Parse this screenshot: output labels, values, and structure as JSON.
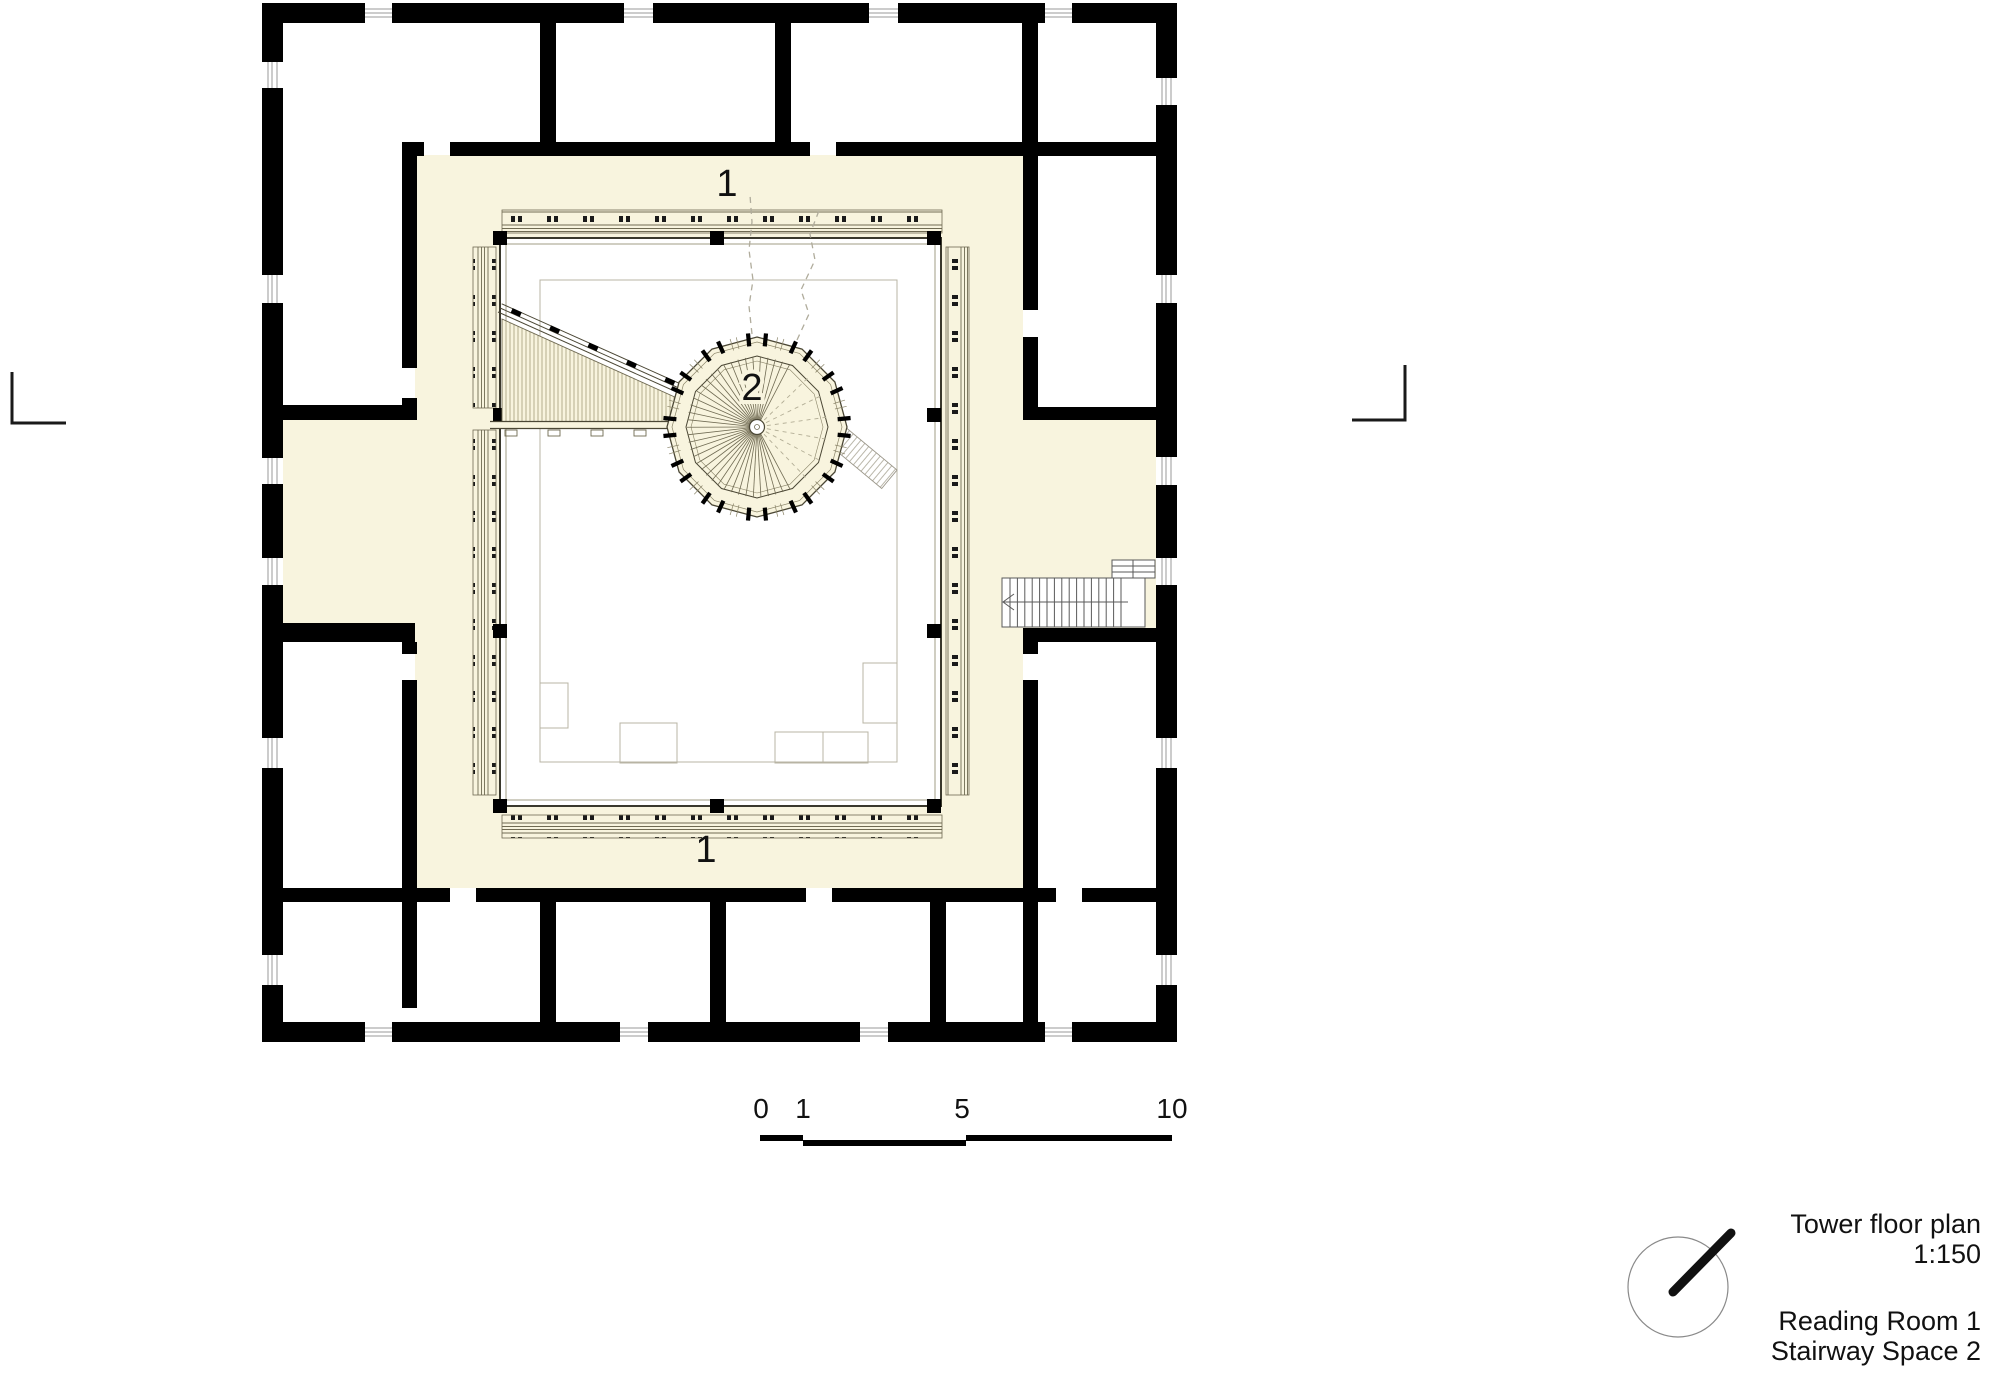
{
  "annotations": {
    "zone_top": "1",
    "zone_bottom": "1",
    "zone_stair": "2"
  },
  "scale_bar": {
    "ticks": [
      "0",
      "1",
      "5",
      "10"
    ]
  },
  "title_block": {
    "title": "Tower floor plan",
    "scale": "1:150",
    "legend_line1": "Reading Room 1",
    "legend_line2": "Stairway Space 2"
  },
  "colors": {
    "wall": "#000000",
    "floor_cream": "#f8f4de",
    "drawing_line": "#6f6a52",
    "light_line": "#b0ac9c"
  }
}
